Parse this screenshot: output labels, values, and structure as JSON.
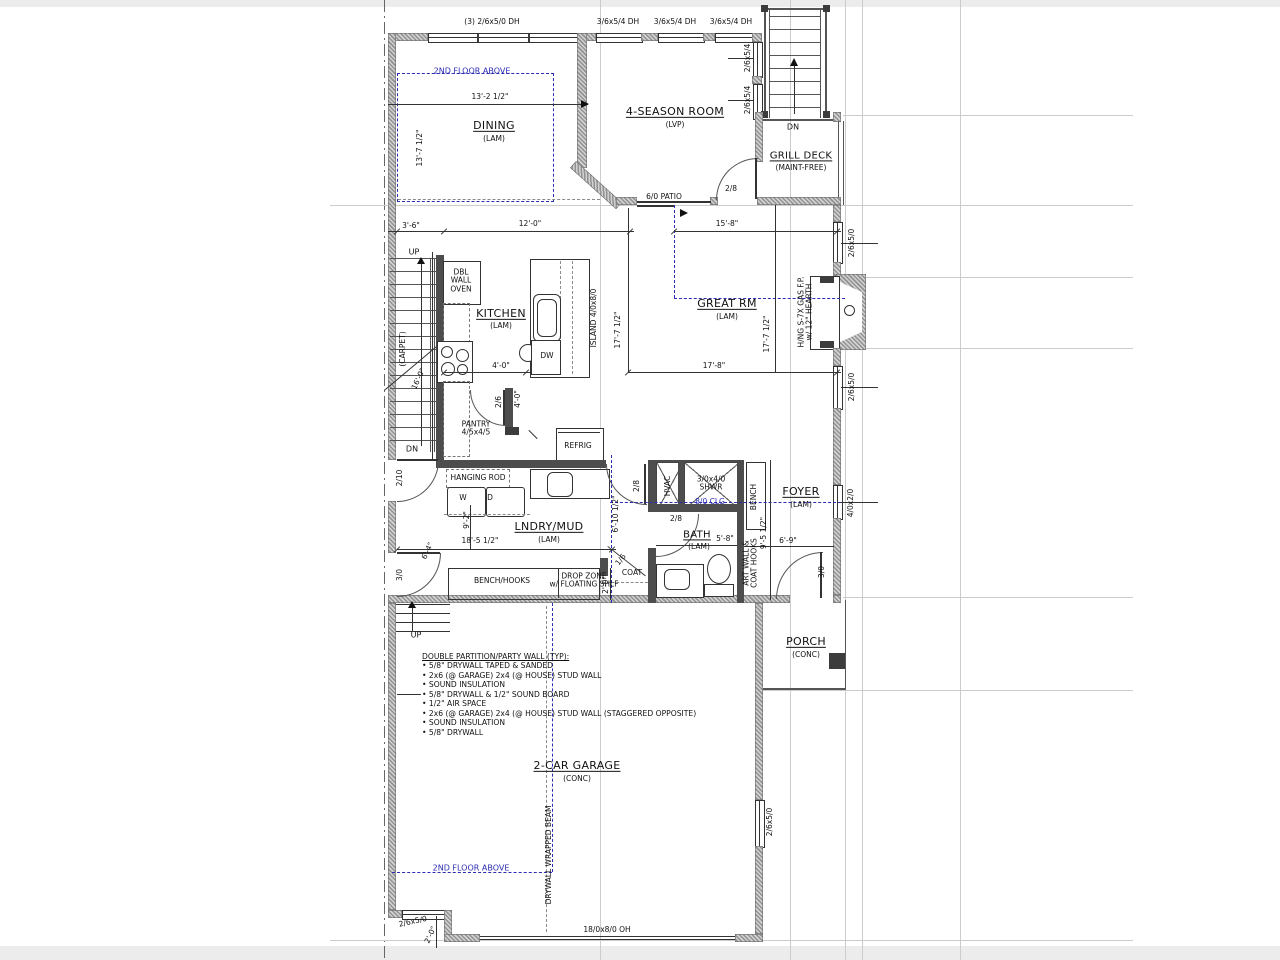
{
  "rooms": {
    "dining": {
      "name": "DINING"
    },
    "four_season": {
      "name": "4-SEASON ROOM",
      "finish": "(LVP)"
    },
    "grill_deck": {
      "name": "GRILL DECK",
      "finish": "(MAINT-FREE)"
    },
    "kitchen": {
      "name": "KITCHEN"
    },
    "great_rm": {
      "name": "GREAT RM"
    },
    "pantry": {
      "name": "PANTRY\n4/5x4/5"
    },
    "lndry_mud": {
      "name": "LNDRY/MUD"
    },
    "bath": {
      "name": "BATH"
    },
    "foyer": {
      "name": "FOYER"
    },
    "porch": {
      "name": "PORCH",
      "finish": "(CONC)"
    },
    "garage": {
      "name": "2-CAR GARAGE",
      "finish": "(CONC)"
    }
  },
  "finishes": {
    "lam": "(LAM)"
  },
  "windows": {
    "triple_dh": "(3) 2/6x5/0 DH",
    "dh_3654": "3/6x5/4 DH",
    "w_2654": "2/6x5/4",
    "w_2650": "2/6x5/0",
    "w_4020": "4/0x2/0"
  },
  "doors": {
    "patio": "6/0 PATIO",
    "d_28": "2/8",
    "d_26": "2/6",
    "d_16": "1/6",
    "d_30": "3/0",
    "d_210": "2/10",
    "garage_oh": "18/0x8/0 OH"
  },
  "dims": {
    "d13_2": "13'-2 1/2\"",
    "d13_7": "13'-7 1/2\"",
    "d3_6": "3'-6\"",
    "d12_0": "12'-0\"",
    "d15_8": "15'-8\"",
    "d17_7": "17'-7 1/2\"",
    "d17_8": "17'-8\"",
    "d16_0": "16'-0\"",
    "d4_0": "4'-0\"",
    "d9_2": "9'-2\"",
    "d18_5": "18'-5 1/2\"",
    "d6_10": "6'-10 1/2\"",
    "d9_5": "9'-5 1/2\"",
    "d5_8": "5'-8\"",
    "d6_9": "6'-9\"",
    "d6_4": "6'-4\"",
    "d2_0": "2'-0\""
  },
  "fixtures": {
    "oven": "DBL\nWALL\nOVEN",
    "island": "ISLAND 4/0x8/0",
    "dw": "DW",
    "refrig": "REFRIG",
    "hanging_rod": "HANGING ROD",
    "washer": "W",
    "dryer": "D",
    "hvac": "HVAC",
    "shower": "3/0x4/0\nSHWR",
    "bench": "BENCH",
    "bench_hooks": "BENCH/HOOKS",
    "drop_zone": "DROP ZONE\nw/ FLOATING SHLF",
    "coat": "COAT",
    "art_wall": "ART WALL &\nCOAT HOOKS",
    "fireplace": "H/NG S-7X GAS F.P.\nw/ 12\" HEARTH",
    "beam": "DRYWALL WRAPPED BEAM",
    "carpet": "(CARPET)"
  },
  "annotations": {
    "second_floor": "2ND FLOOR ABOVE",
    "clg": "8/0 CLG",
    "up": "UP",
    "dn": "DN"
  },
  "notes": {
    "title": "DOUBLE PARTITION/PARTY WALL (TYP):",
    "items": [
      "• 5/8\" DRYWALL TAPED & SANDED",
      "• 2x6 (@ GARAGE) 2x4 (@ HOUSE) STUD WALL",
      "• SOUND INSULATION",
      "• 5/8\" DRYWALL & 1/2\" SOUND BOARD",
      "• 1/2\" AIR SPACE",
      "• 2x6 (@ GARAGE) 2x4 (@ HOUSE) STUD WALL (STAGGERED OPPOSITE)",
      "• SOUND INSULATION",
      "• 5/8\" DRYWALL"
    ]
  }
}
